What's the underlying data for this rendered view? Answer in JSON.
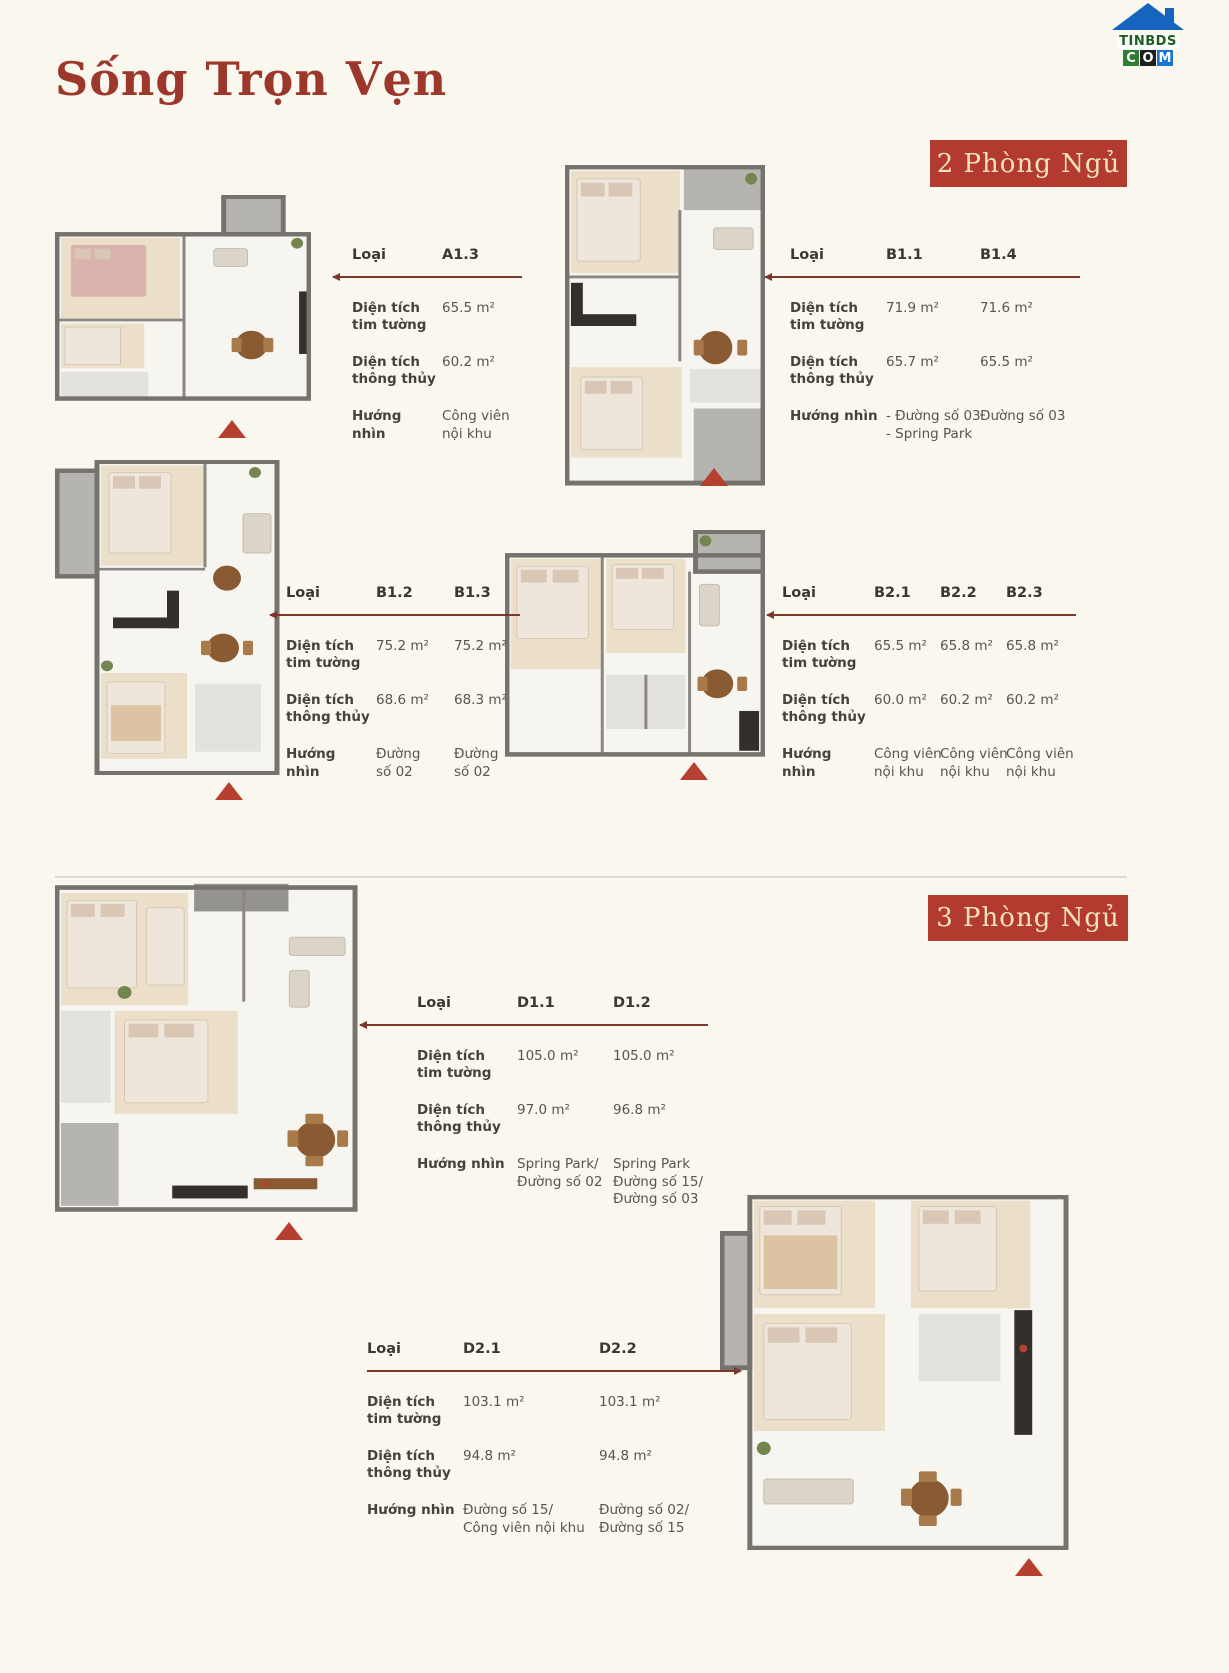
{
  "page": {
    "title": "Sống Trọn Vẹn",
    "bg_color": "#faf7ee",
    "accent_color": "#b23a2e"
  },
  "logo": {
    "top_text": "TINBDS",
    "letters": [
      "C",
      "O",
      "M"
    ],
    "roof_color": "#1565c0",
    "top_text_color": "#1b5e20",
    "letter_bg": [
      "#2e7d32",
      "#1f1f1f",
      "#1976d2"
    ]
  },
  "sections": {
    "two_bedroom": {
      "label": "2 Phòng Ngủ"
    },
    "three_bedroom": {
      "label": "3 Phòng Ngủ"
    }
  },
  "spec_labels": {
    "type": "Loại",
    "gross": "Diện tích tim tường",
    "net": "Diện tích thông thủy",
    "view": "Hướng nhìn"
  },
  "tables": [
    {
      "plan": "A1.3",
      "columns": [
        {
          "type": "A1.3",
          "gross": "65.5 m²",
          "net": "60.2 m²",
          "view": "Công viên\nnội khu"
        }
      ]
    },
    {
      "plan": "B1.1 / B1.4",
      "columns": [
        {
          "type": "B1.1",
          "gross": "71.9 m²",
          "net": "65.7 m²",
          "view": "- Đường số 03\n- Spring Park"
        },
        {
          "type": "B1.4",
          "gross": "71.6 m²",
          "net": "65.5 m²",
          "view": "Đường số 03"
        }
      ]
    },
    {
      "plan": "B1.2 / B1.3",
      "columns": [
        {
          "type": "B1.2",
          "gross": "75.2 m²",
          "net": "68.6 m²",
          "view": "Đường\nsố 02"
        },
        {
          "type": "B1.3",
          "gross": "75.2 m²",
          "net": "68.3 m²",
          "view": "Đường\nsố 02"
        }
      ]
    },
    {
      "plan": "B2.1 / B2.2 / B2.3",
      "columns": [
        {
          "type": "B2.1",
          "gross": "65.5 m²",
          "net": "60.0 m²",
          "view": "Công viên\nnội khu"
        },
        {
          "type": "B2.2",
          "gross": "65.8 m²",
          "net": "60.2 m²",
          "view": "Công viên\nnội khu"
        },
        {
          "type": "B2.3",
          "gross": "65.8 m²",
          "net": "60.2 m²",
          "view": "Công viên\nnội khu"
        }
      ]
    },
    {
      "plan": "D1.1 / D1.2",
      "columns": [
        {
          "type": "D1.1",
          "gross": "105.0 m²",
          "net": "97.0 m²",
          "view": "Spring Park/\nĐường số 02"
        },
        {
          "type": "D1.2",
          "gross": "105.0 m²",
          "net": "96.8 m²",
          "view": "Spring Park\nĐường số 15/\nĐường số 03"
        }
      ]
    },
    {
      "plan": "D2.1 / D2.2",
      "columns": [
        {
          "type": "D2.1",
          "gross": "103.1 m²",
          "net": "94.8 m²",
          "view": "Đường số 15/\nCông viên nội khu"
        },
        {
          "type": "D2.2",
          "gross": "103.1 m²",
          "net": "94.8 m²",
          "view": "Đường số 02/\nĐường số 15"
        }
      ]
    }
  ]
}
